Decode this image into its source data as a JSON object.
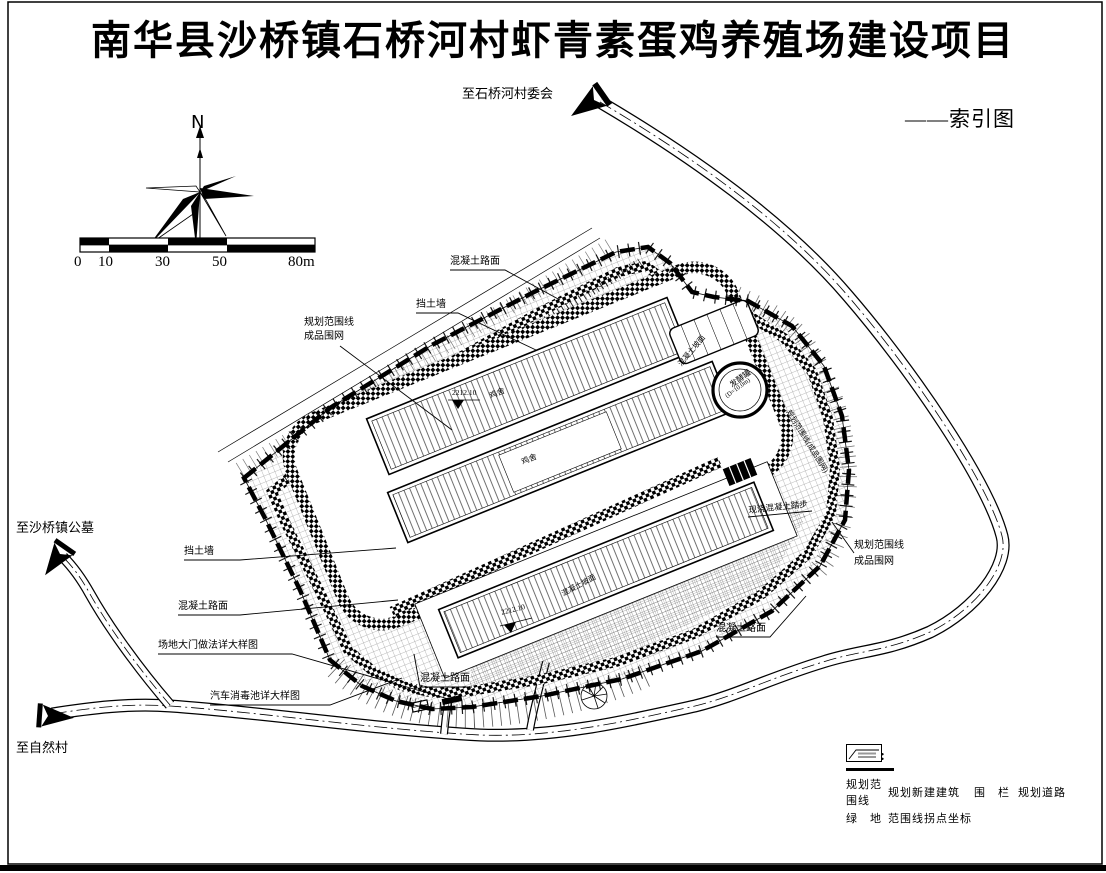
{
  "title": "南华县沙桥镇石桥河村虾青素蛋鸡养殖场建设项目",
  "index_label": "——索引图",
  "compass": {
    "north": "N"
  },
  "scale_bar": {
    "t0": "0",
    "t1": "10",
    "t2": "30",
    "t3": "50",
    "t4": "80m"
  },
  "destinations": {
    "village_committee": "至石桥河村委会",
    "cemetery": "至沙桥镇公墓",
    "natural_village": "至自然村"
  },
  "callouts": {
    "concrete_road_top": "混凝土路面",
    "retaining_wall_top": "挡土墙",
    "boundary_line_left": "规划范围线",
    "fence_left": "成品围网",
    "retaining_wall_left": "挡土墙",
    "concrete_road_left": "混凝土路面",
    "gate_detail": "场地大门做法详大样图",
    "car_disinfection": "汽车消毒池详大样图",
    "concrete_road_bottom": "混凝土路面",
    "concrete_road_right": "混凝土路面",
    "boundary_line_right": "规划范围线",
    "fence_right": "成品围网",
    "concrete_steps": "现浇混凝土踏步",
    "boundary_inline": "规划范围线(成品围网)",
    "slope_inline": "混凝土坡面",
    "slope_inline2": "混凝土坡面",
    "henhouse1": "鸡舍",
    "henhouse2": "鸡舍"
  },
  "plan": {
    "tank_name": "发酵罐",
    "tank_size": "(D=10.0m)",
    "elevation_a": "2212.10",
    "elevation_b": "2212.10"
  },
  "legend": {
    "title": "图例:",
    "items": [
      {
        "label": "规划范围线"
      },
      {
        "label": "围　栏"
      },
      {
        "label": "绿　地"
      },
      {
        "label": "规划新建建筑"
      },
      {
        "label": "规划道路"
      },
      {
        "label": "范围线拐点坐标"
      }
    ]
  }
}
